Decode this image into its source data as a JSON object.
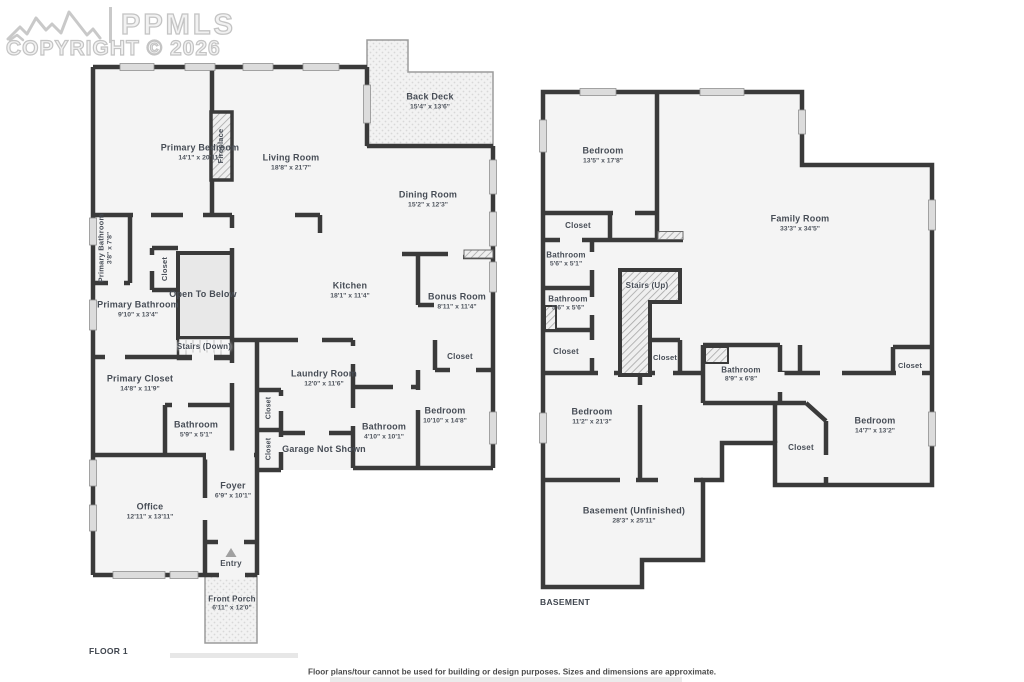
{
  "watermark": {
    "brand": "PPMLS",
    "copyright": "COPYRIGHT © 2026"
  },
  "footer": {
    "disclaimer": "Floor plans/tour cannot be used for building or design purposes. Sizes and dimensions are approximate."
  },
  "colors": {
    "wall": "#3a3a3a",
    "room_fill": "#f4f4f4",
    "open_to_below_fill": "#e8e8e8",
    "label_text": "#474d56",
    "watermark": "#c4c4c4"
  },
  "floor1": {
    "title": "FLOOR 1",
    "rooms": {
      "primary_bedroom": {
        "name": "Primary Bedroom",
        "dims": "14'1\" x 20'11\""
      },
      "living_room": {
        "name": "Living Room",
        "dims": "18'8\" x 21'7\""
      },
      "back_deck": {
        "name": "Back Deck",
        "dims": "15'4\" x 13'6\""
      },
      "fireplace": {
        "name": "Fireplace"
      },
      "dining_room": {
        "name": "Dining Room",
        "dims": "15'2\" x 12'3\""
      },
      "primary_bathroom_small": {
        "name": "Primary Bathroom",
        "dims": "3'8\" x 7'8\""
      },
      "hall_closet": {
        "name": "Closet"
      },
      "open_to_below": {
        "name": "Open To Below"
      },
      "primary_bathroom": {
        "name": "Primary Bathroom",
        "dims": "9'10\" x 13'4\""
      },
      "stairs_down": {
        "name": "Stairs (Down)"
      },
      "kitchen": {
        "name": "Kitchen",
        "dims": "18'1\" x 11'4\""
      },
      "bonus_room": {
        "name": "Bonus Room",
        "dims": "8'11\" x 11'4\""
      },
      "primary_closet": {
        "name": "Primary Closet",
        "dims": "14'8\" x 11'9\""
      },
      "bathroom_hall": {
        "name": "Bathroom",
        "dims": "5'9\" x 5'1\""
      },
      "laundry_room": {
        "name": "Laundry Room",
        "dims": "12'0\" x 11'6\""
      },
      "closet_a": {
        "name": "Closet"
      },
      "closet_b": {
        "name": "Closet"
      },
      "garage": {
        "name": "Garage Not Shown"
      },
      "bathroom_bed": {
        "name": "Bathroom",
        "dims": "4'10\" x 10'1\""
      },
      "bedroom_closet": {
        "name": "Closet"
      },
      "bedroom": {
        "name": "Bedroom",
        "dims": "10'10\" x 14'8\""
      },
      "office": {
        "name": "Office",
        "dims": "12'11\" x 13'11\""
      },
      "foyer": {
        "name": "Foyer",
        "dims": "6'9\" x 10'1\""
      },
      "entry": {
        "name": "Entry"
      },
      "front_porch": {
        "name": "Front Porch",
        "dims": "6'11\" x 12'0\""
      }
    }
  },
  "basement": {
    "title": "BASEMENT",
    "rooms": {
      "bedroom_nw": {
        "name": "Bedroom",
        "dims": "13'5\" x 17'8\""
      },
      "family_room": {
        "name": "Family Room",
        "dims": "33'3\" x 34'5\""
      },
      "closet_top": {
        "name": "Closet"
      },
      "bathroom_a": {
        "name": "Bathroom",
        "dims": "5'6\" x 5'1\""
      },
      "bathroom_b": {
        "name": "Bathroom",
        "dims": "5'6\" x 5'6\""
      },
      "stairs_up": {
        "name": "Stairs (Up)"
      },
      "closet_ml": {
        "name": "Closet"
      },
      "closet_stairs": {
        "name": "Closet"
      },
      "bathroom_c": {
        "name": "Bathroom",
        "dims": "8'9\" x 6'8\""
      },
      "closet_fr": {
        "name": "Closet"
      },
      "bedroom_e": {
        "name": "Bedroom",
        "dims": "14'7\" x 13'2\""
      },
      "closet_mid": {
        "name": "Closet"
      },
      "bedroom_w": {
        "name": "Bedroom",
        "dims": "11'2\" x 21'3\""
      },
      "unfinished": {
        "name": "Basement (Unfinished)",
        "dims": "28'3\" x 25'11\""
      }
    }
  }
}
